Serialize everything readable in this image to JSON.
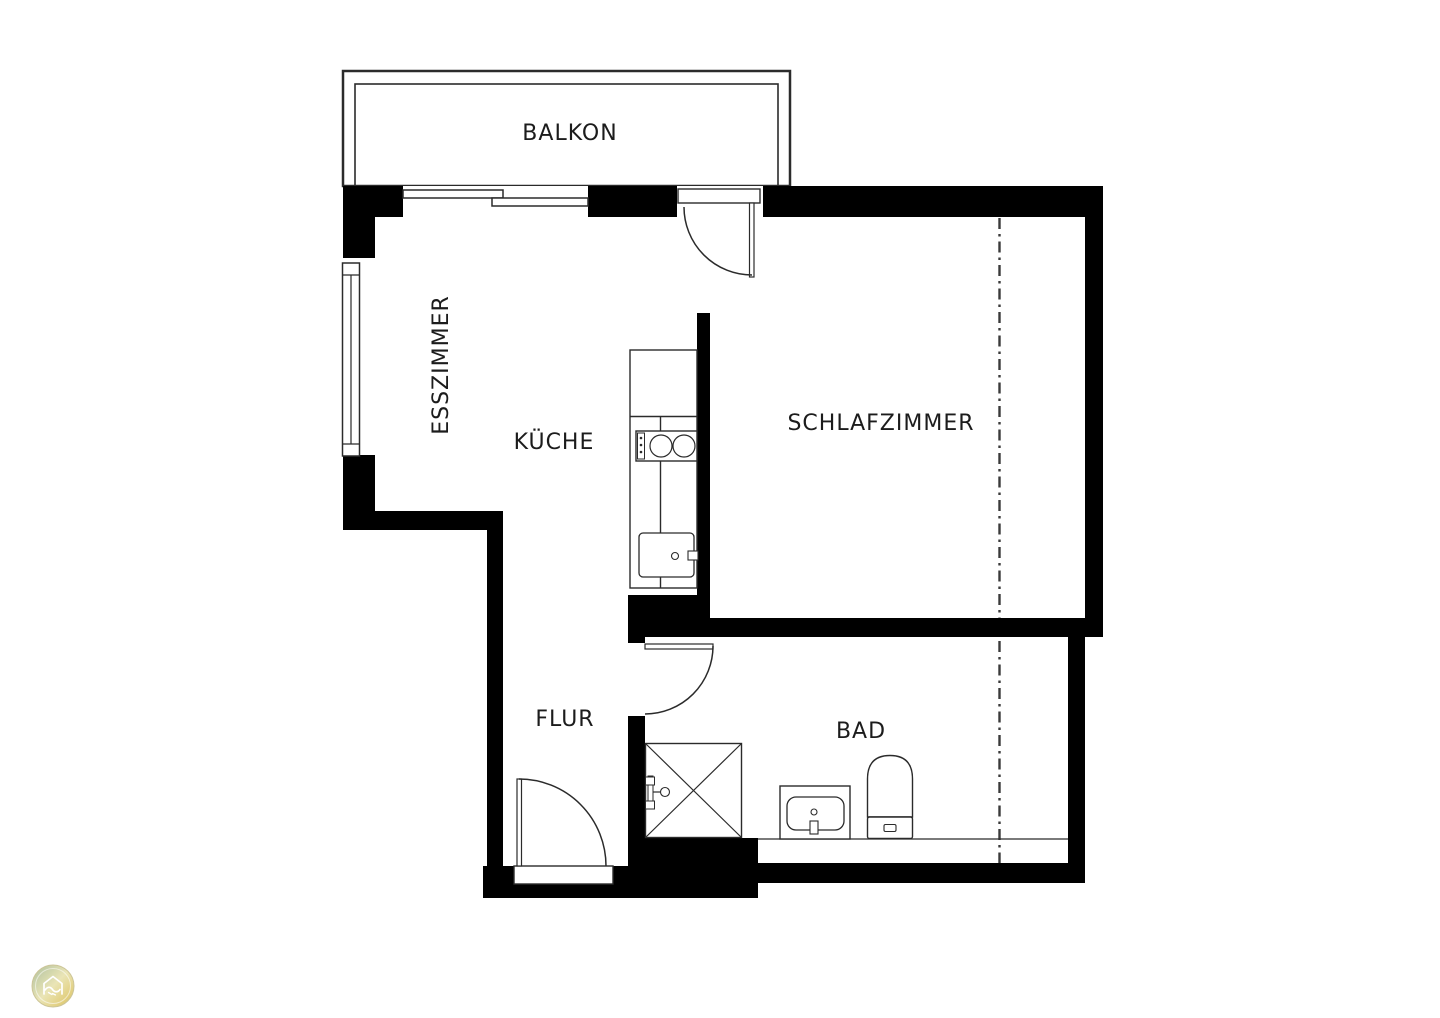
{
  "rooms": {
    "balkon": {
      "label": "BALKON"
    },
    "esszimmer": {
      "label": "ESSZIMMER"
    },
    "kueche": {
      "label": "KÜCHE"
    },
    "schlafzimmer": {
      "label": "SCHLAFZIMMER"
    },
    "flur": {
      "label": "FLUR"
    },
    "bad": {
      "label": "BAD"
    }
  },
  "icons": {
    "logo": "house-handshake-icon"
  },
  "colors": {
    "background": "#ffffff",
    "wall": "#000000",
    "outline": "#2b2b2b",
    "text": "#1c1c1c",
    "section_line": "#3a3a3a",
    "logo_green": "#a7bb96",
    "logo_light": "#e9e3b0",
    "logo_gold": "#d9bc4e"
  }
}
